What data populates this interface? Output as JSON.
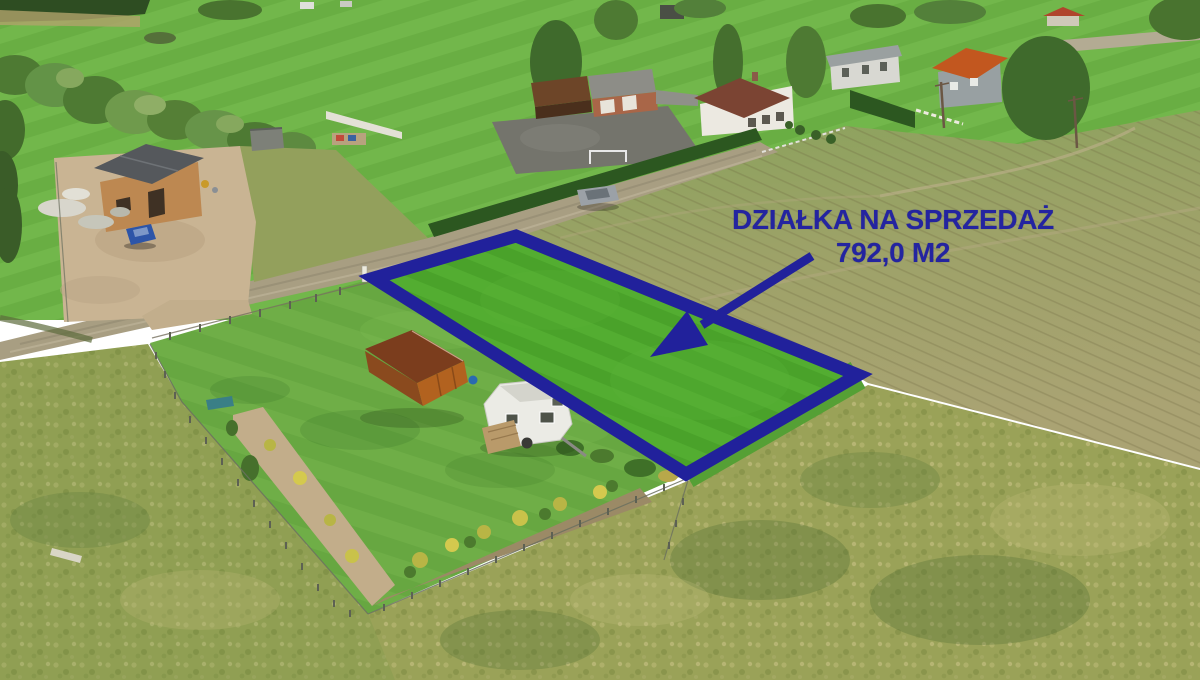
{
  "overlay": {
    "title": "DZIAŁKA NA SPRZEDAŻ",
    "area": "792,0 M2"
  },
  "colors": {
    "annotation_blue": "#21219B",
    "plot_lawn_green": "#4AA22A",
    "garden_lawn_green": "#67A741",
    "stubble_field_khaki": "#A9A373",
    "tall_grass_olive": "#9AA258",
    "road_tan": "#A89E82",
    "shed_orange": "#B2621F",
    "caravan_white": "#EBEBE5"
  },
  "scene": {
    "type": "aerial-drone-photo",
    "objects": [
      {
        "name": "plot-outline",
        "label": "blue boundary of the plot for sale"
      },
      {
        "name": "plot-arrow",
        "label": "blue arrow pointing into the plot"
      },
      {
        "name": "plot-lawn",
        "label": "mowed green lawn inside outlined plot"
      },
      {
        "name": "wooden-shed",
        "label": "brown wooden shed"
      },
      {
        "name": "caravan",
        "label": "white camping caravan"
      },
      {
        "name": "parked-car",
        "label": "silver car on dirt road"
      },
      {
        "name": "blue-car",
        "label": "blue car at construction site"
      },
      {
        "name": "construction-house",
        "label": "brick house under construction"
      },
      {
        "name": "white-house",
        "label": "white house with brown roof"
      },
      {
        "name": "gray-house",
        "label": "gray house"
      },
      {
        "name": "orange-roof-house",
        "label": "house with orange roof"
      },
      {
        "name": "garage-building",
        "label": "brick garage building"
      },
      {
        "name": "dirt-road",
        "label": "dirt road"
      },
      {
        "name": "hedge",
        "label": "tall conifer hedge"
      },
      {
        "name": "soccer-goal",
        "label": "soccer goal in field"
      },
      {
        "name": "stubble-field",
        "label": "harvested khaki field"
      },
      {
        "name": "tall-grass-meadow",
        "label": "unmowed tall grass meadow"
      }
    ]
  }
}
